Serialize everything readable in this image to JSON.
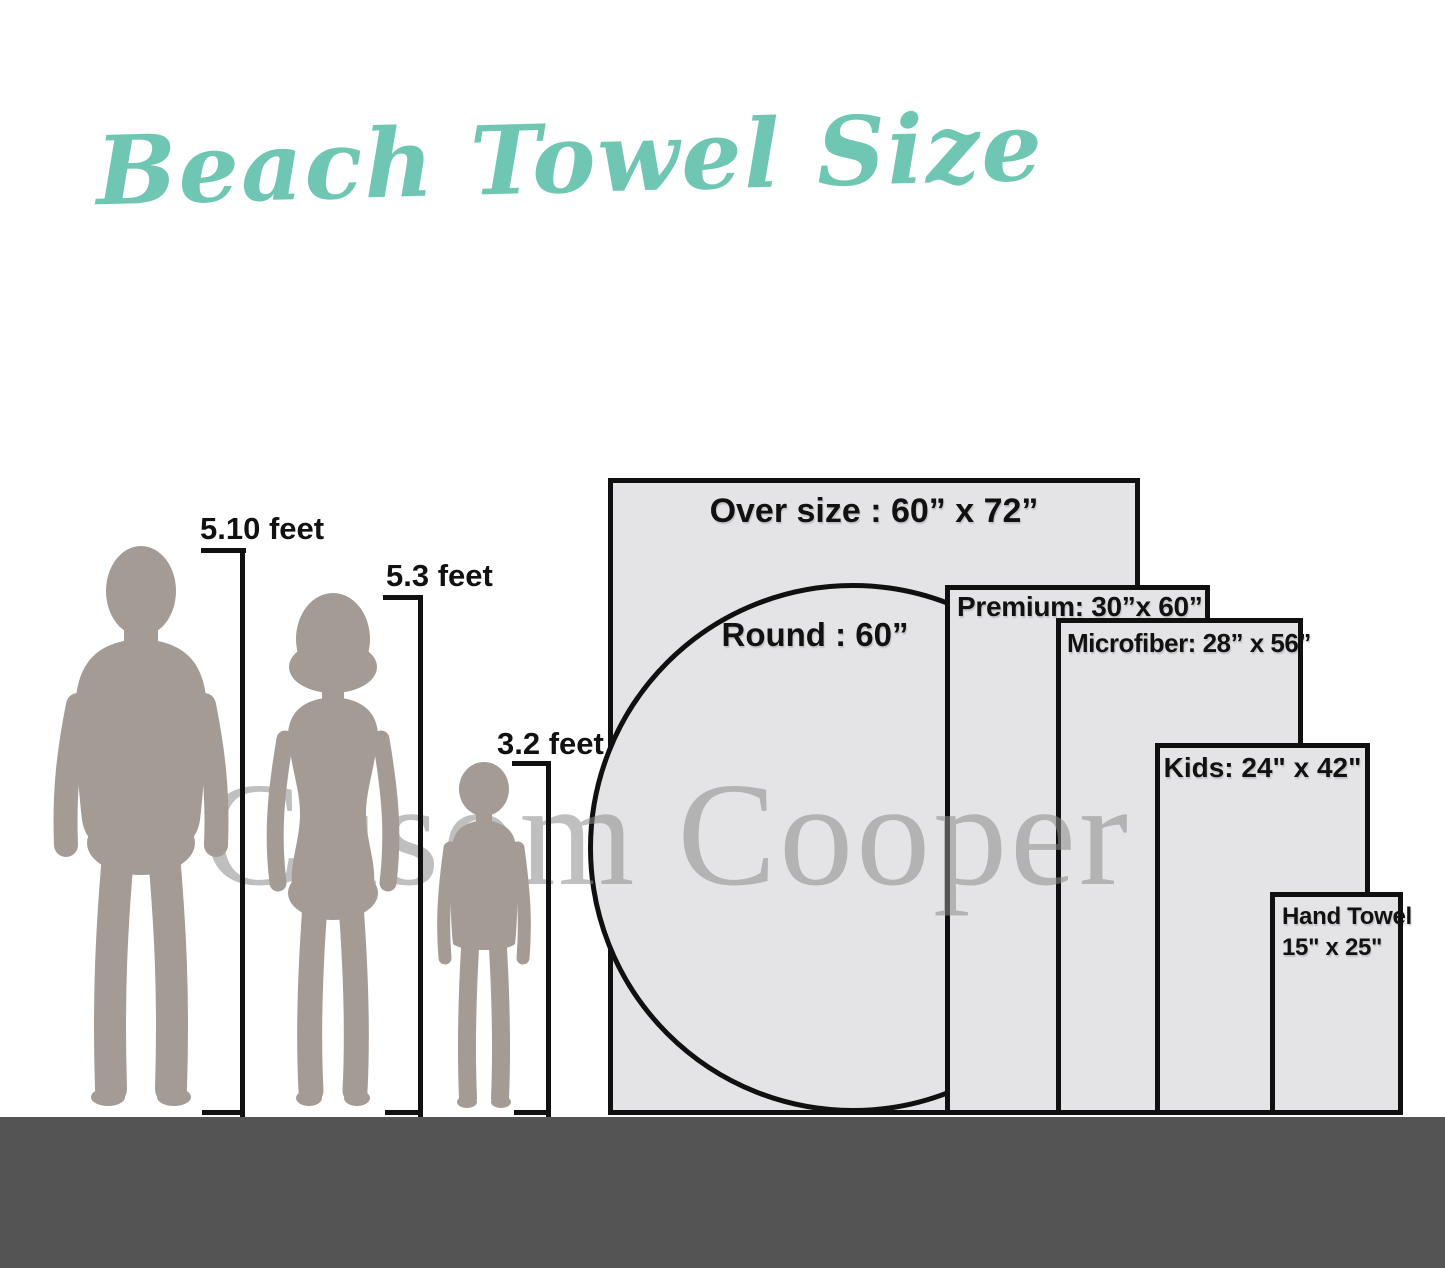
{
  "title": {
    "text": "Beach Towel Size"
  },
  "watermark": {
    "text": "Cusom Cooper"
  },
  "people": [
    {
      "name": "man",
      "height_label": "5.10 feet"
    },
    {
      "name": "woman",
      "height_label": "5.3 feet"
    },
    {
      "name": "child",
      "height_label": "3.2 feet"
    }
  ],
  "towels": [
    {
      "name": "oversize",
      "shape": "rectangle",
      "label": "Over size : 60” x 72”",
      "width_in": 60,
      "length_in": 72
    },
    {
      "name": "round",
      "shape": "circle",
      "label": "Round : 60”",
      "diameter_in": 60
    },
    {
      "name": "premium",
      "shape": "rectangle",
      "label": "Premium:  30”x 60”",
      "width_in": 30,
      "length_in": 60
    },
    {
      "name": "microfiber",
      "shape": "rectangle",
      "label": "Microfiber: 28” x 56”",
      "width_in": 28,
      "length_in": 56
    },
    {
      "name": "kids",
      "shape": "rectangle",
      "label": "Kids: 24\" x 42\"",
      "width_in": 24,
      "length_in": 42
    },
    {
      "name": "hand",
      "shape": "rectangle",
      "label_line1": "Hand Towel",
      "label_line2": "15\" x 25\"",
      "width_in": 15,
      "length_in": 25
    }
  ],
  "colors": {
    "title": "#6fc7b3",
    "silhouette": "#a39b94",
    "towel_fill": "#e4e4e6",
    "towel_border": "#101010",
    "ground": "#545454",
    "watermark": "#8c8c8c",
    "label_text": "#111111"
  }
}
